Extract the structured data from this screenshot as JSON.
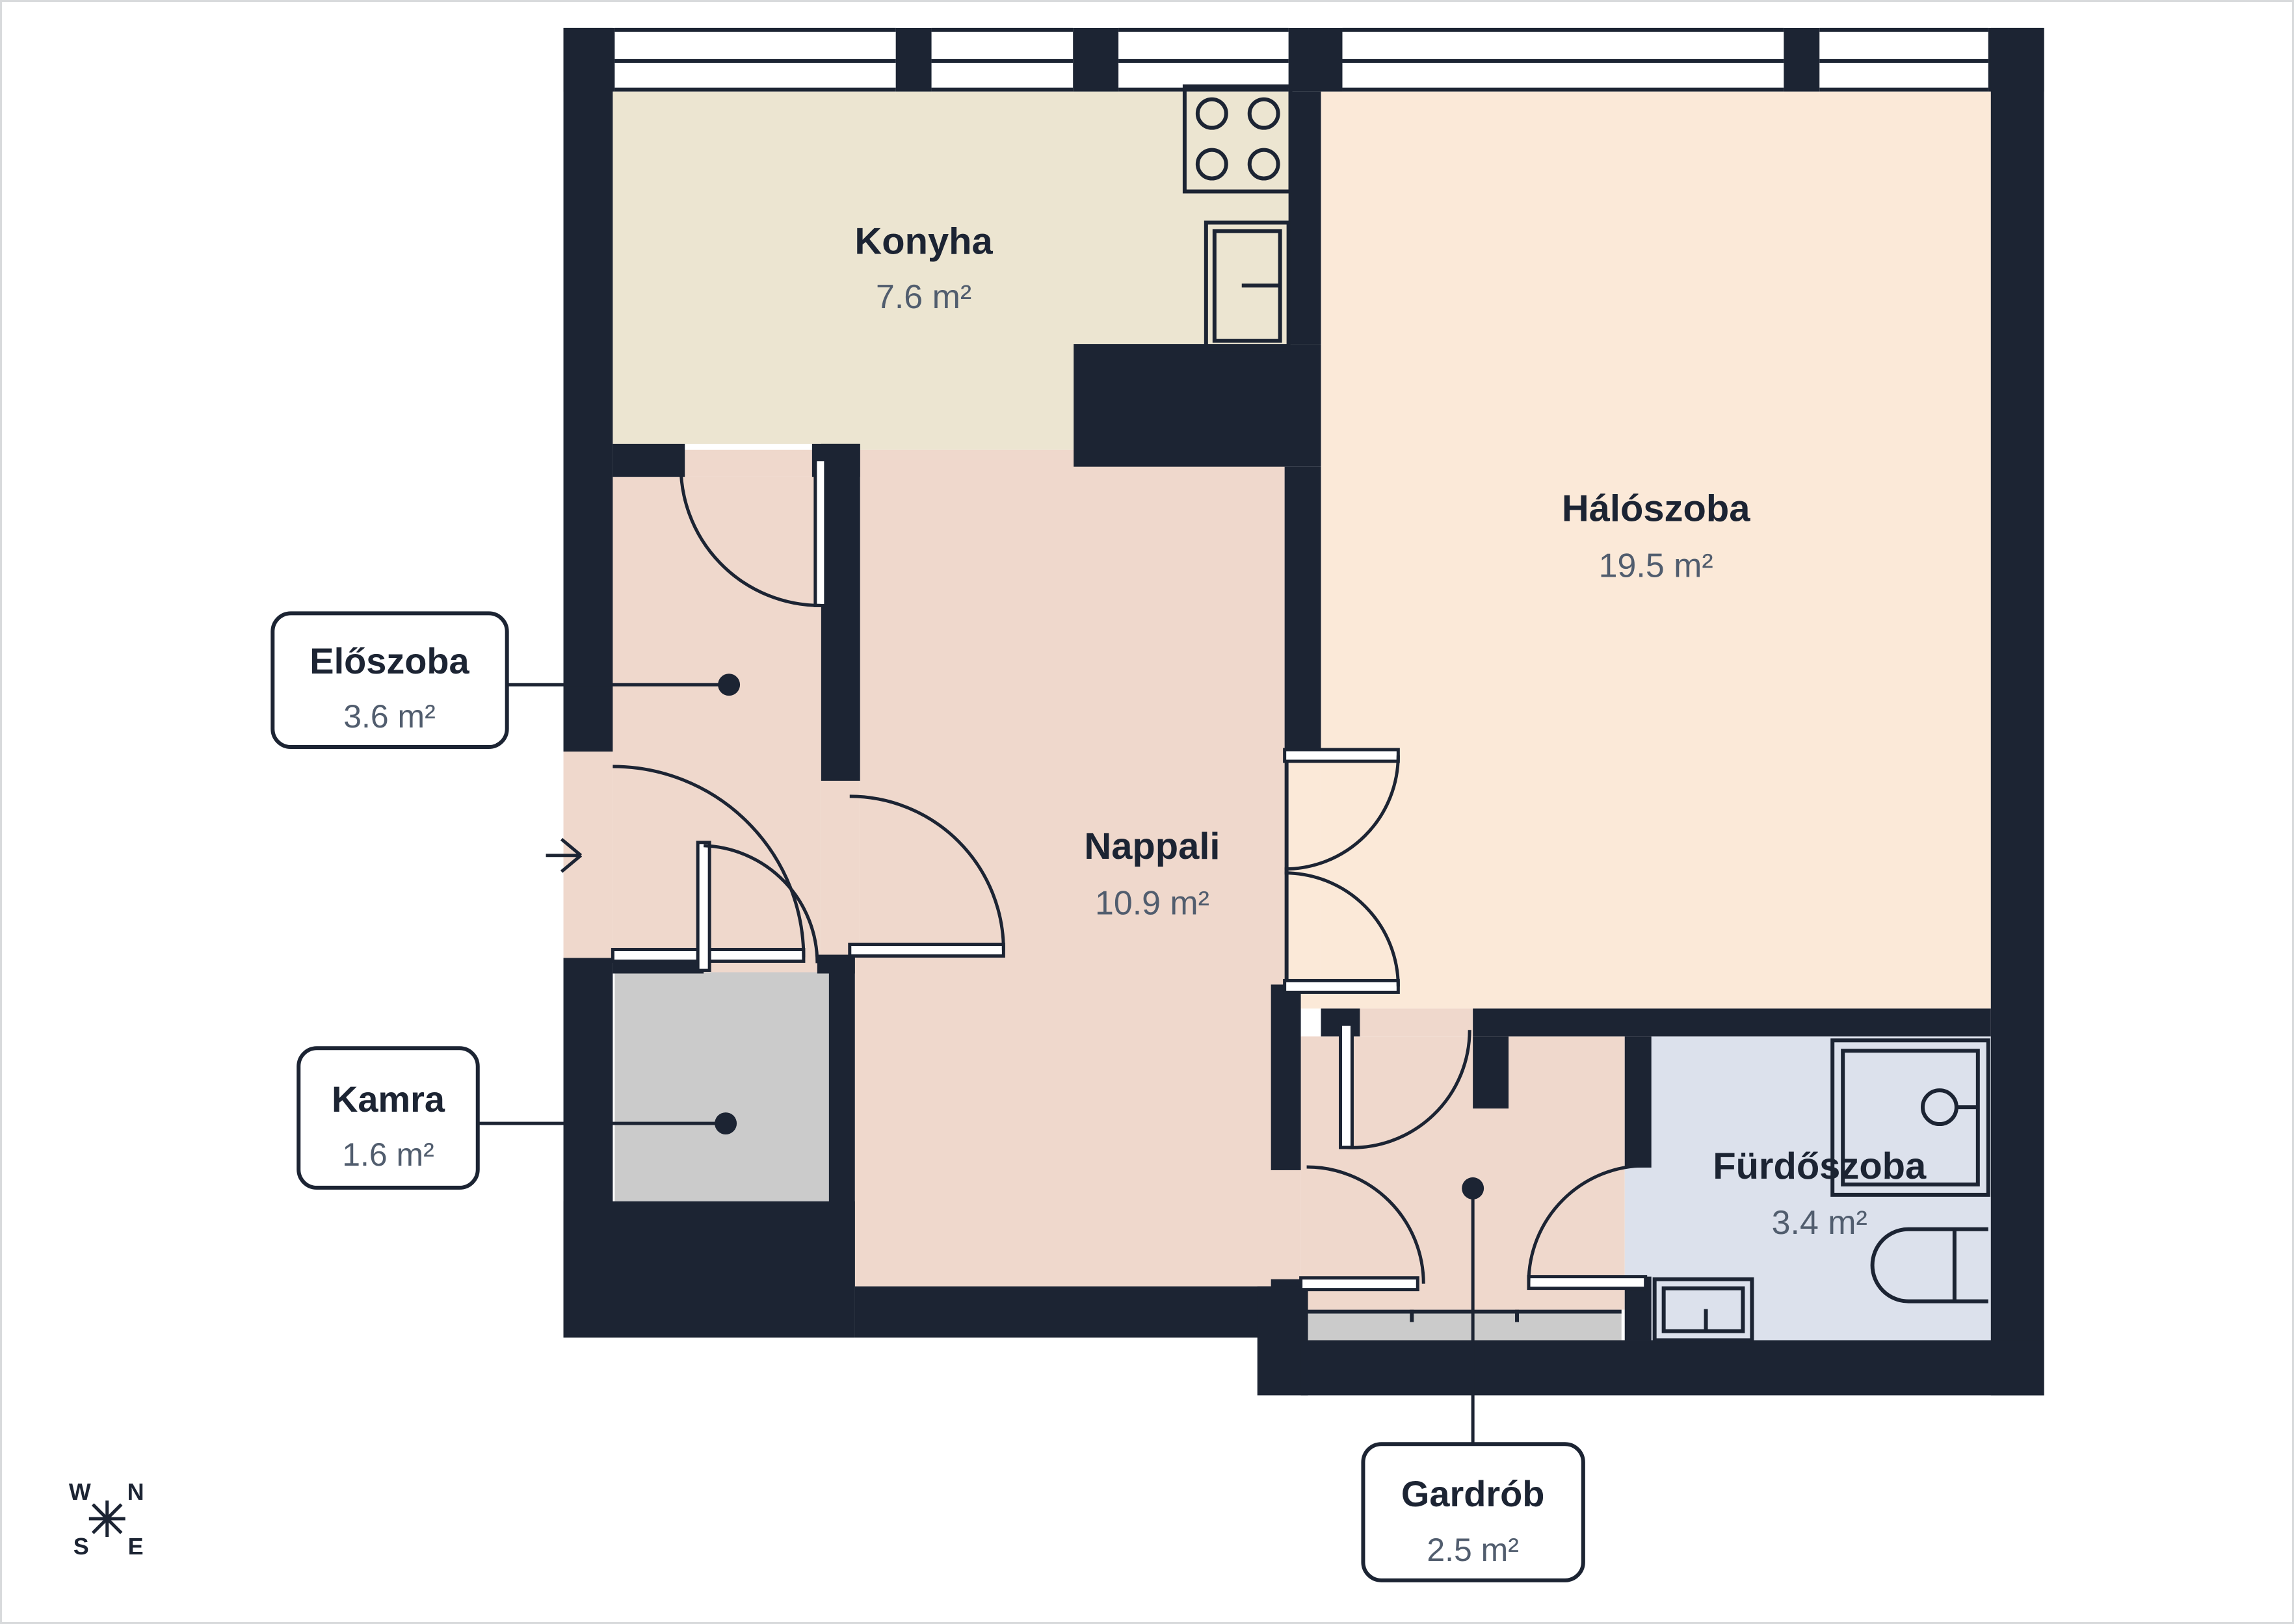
{
  "rooms": {
    "konyha": {
      "name": "Konyha",
      "area": "7.6 m²"
    },
    "haloszoba": {
      "name": "Hálószoba",
      "area": "19.5 m²"
    },
    "nappali": {
      "name": "Nappali",
      "area": "10.9 m²"
    },
    "furdoszoba": {
      "name": "Fürdőszoba",
      "area": "3.4 m²"
    },
    "eloszoba": {
      "name": "Előszoba",
      "area": "3.6 m²"
    },
    "kamra": {
      "name": "Kamra",
      "area": "1.6 m²"
    },
    "gardrob": {
      "name": "Gardrób",
      "area": "2.5 m²"
    }
  },
  "compass": {
    "west": "W",
    "north": "N",
    "south": "S",
    "east": "E"
  },
  "colors": {
    "wall": "#1c2433",
    "ink": "#1c2433",
    "muted": "#515d6e",
    "kitchen": "#ece5d1",
    "pink": "#efd8cc",
    "peach": "#fbe9d8",
    "gray": "#cbcbcb",
    "bath": "#dce1ec",
    "page_border": "#d8dadc"
  }
}
